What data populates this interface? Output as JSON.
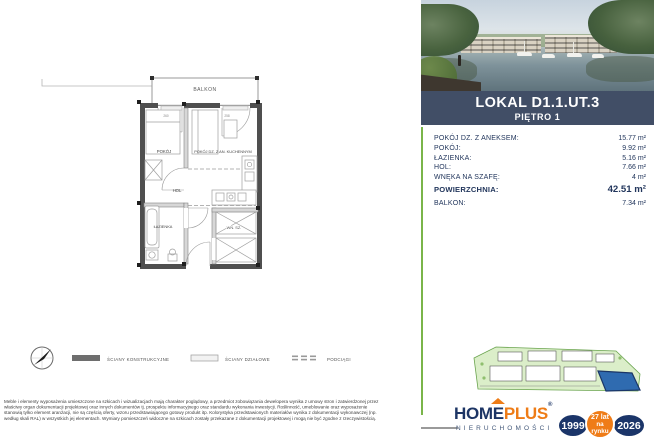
{
  "plan": {
    "room_labels": {
      "balkon": "BALKON",
      "pokoj": "POKÓJ",
      "pokoj_dz": "POKÓJ DZ. Z AN. KUCHENNYM",
      "hol": "HOL",
      "lazienka": "ŁAZIENKA",
      "wn_sz": "WN. SZ."
    },
    "dims": {
      "d1": "260",
      "d2": "258"
    },
    "legend": {
      "konstrukcyjne": "ŚCIANY KONSTRUKCYJNE",
      "dzialowe": "ŚCIANY DZIAŁOWE",
      "podciagi": "PODCIĄGI"
    }
  },
  "disclaimer": {
    "line1": "Meble i elementy wyposażenia umieszczone na szkicach i wizualizacjach mają charakter poglądowy, a przedmiot zobowiązania dewelopera wynika z umowy stron i zatwierdzonej przez",
    "line2": "właściwy organ dokumentacji projektowej oraz innych dokumentów tj. prospektu informacyjnego oraz standardu wykonania inwestycji. Roślinność, umeblowanie oraz wyposażenie",
    "line3": "stanowią tylko element aranżacji, nie są częścią oferty, wzoru przedstawiającego gotowy produkt itp. Kolorystyka przedstawionych materiałów wynika z dokumentacji wykonawczej (np.",
    "line4": "według skali RAL) w wszystkich jej elementach. Wymiary pomieszczeń widoczne na szkicach zostały przekazane z dokumentacji projektowej i mogą nie być zgodne z rzeczywistością."
  },
  "unit": {
    "title": "LOKAL D1.1.UT.3",
    "floor": "PIĘTRO 1",
    "rows": [
      {
        "label": "POKÓJ DZ. Z ANEKSEM:",
        "value": "15.77 m²"
      },
      {
        "label": "POKÓJ:",
        "value": "9.92 m²"
      },
      {
        "label": "ŁAZIENKA:",
        "value": "5.16 m²"
      },
      {
        "label": "HOL:",
        "value": "7.66 m²"
      },
      {
        "label": "WNĘKA NA SZAFĘ:",
        "value": "4 m²"
      },
      {
        "label": "POWIERZCHNIA:",
        "value": "42.51 m²"
      },
      {
        "label": "BALKON:",
        "value": "7.34 m²"
      }
    ]
  },
  "brand": {
    "name_left": "HOM",
    "name_mid": "E",
    "name_right": "PLUS",
    "registered": "®",
    "subtitle": "NIERUCHOMOŚCI",
    "badge_start_year": "1999",
    "badge_years": "27 lat",
    "badge_on_market": "na rynku",
    "badge_end_year": "2026"
  },
  "colors": {
    "header_navy": "#414e66",
    "brand_navy": "#1b3569",
    "brand_orange": "#ee7c17",
    "accent_green": "#7ab54a"
  }
}
